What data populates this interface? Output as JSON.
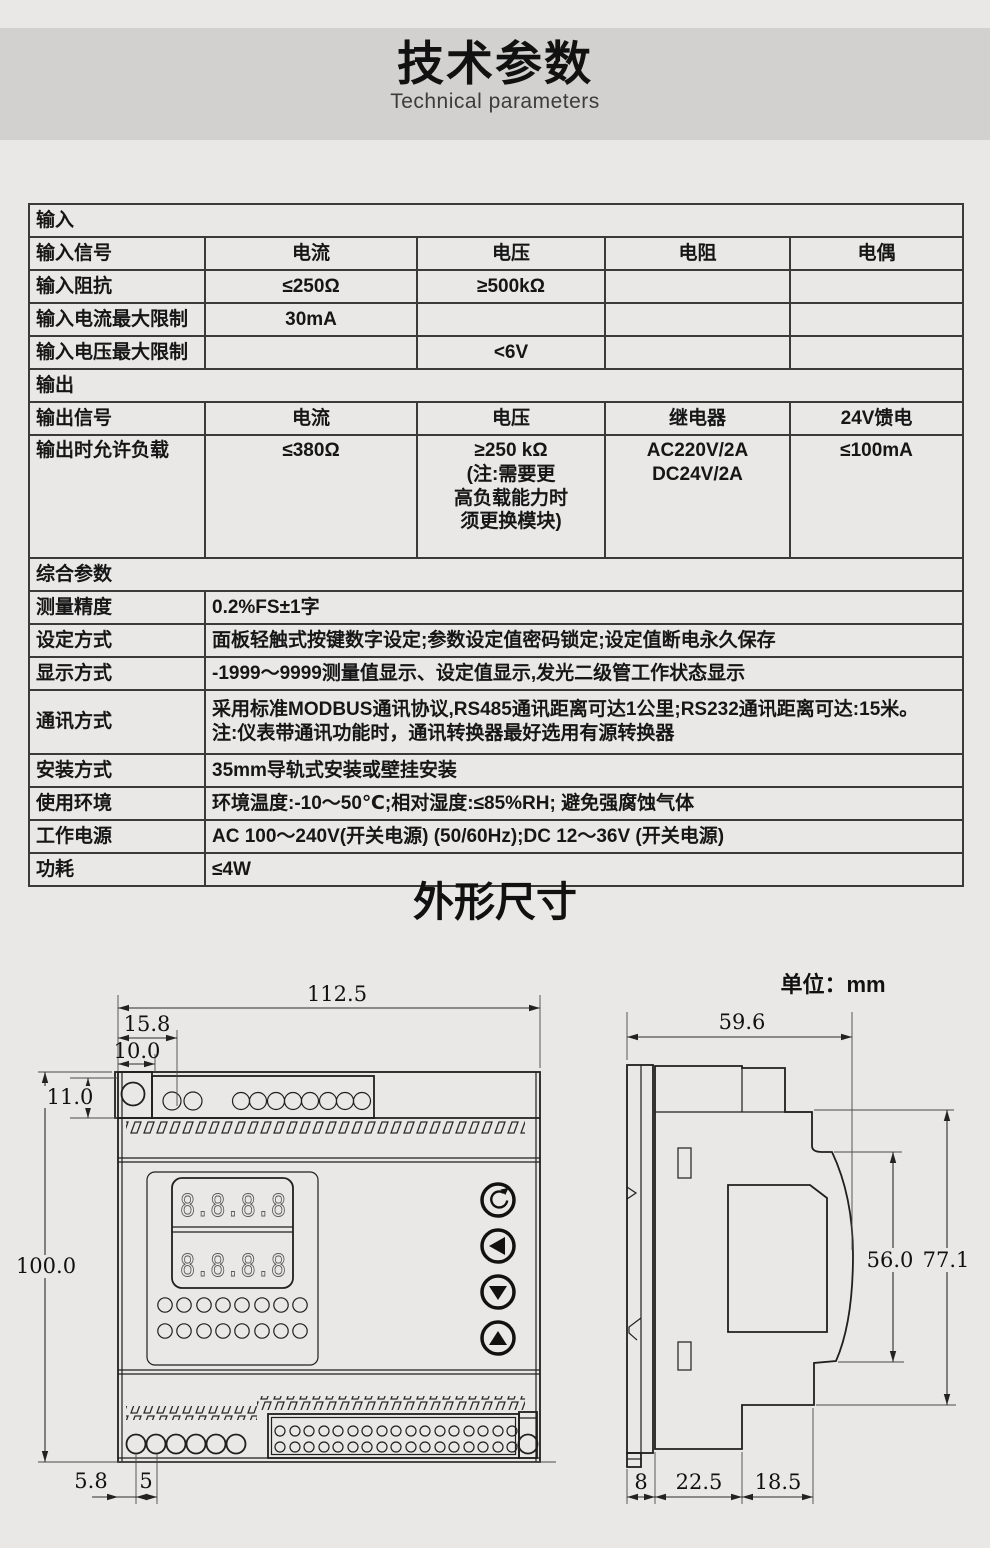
{
  "header": {
    "title": "技术参数",
    "subtitle": "Technical parameters"
  },
  "spec_table": {
    "rows": [
      [
        "输入"
      ],
      [
        "输入信号",
        "电流",
        "电压",
        "电阻",
        "电偶"
      ],
      [
        "输入阻抗",
        "≤250Ω",
        "≥500kΩ",
        "",
        ""
      ],
      [
        "输入电流最大限制",
        "30mA",
        "",
        "",
        ""
      ],
      [
        "输入电压最大限制",
        "",
        "<6V",
        "",
        ""
      ],
      [
        "输出"
      ],
      [
        "输出信号",
        "电流",
        "电压",
        "继电器",
        "24V馈电"
      ],
      [
        "输出时允许负载",
        "≤380Ω",
        "≥250 kΩ\n(注:需要更\n高负载能力时\n须更换模块)",
        "AC220V/2A\nDC24V/2A",
        "≤100mA"
      ],
      [
        "综合参数"
      ],
      [
        "测量精度",
        "0.2%FS±1字"
      ],
      [
        "设定方式",
        "面板轻触式按键数字设定;参数设定值密码锁定;设定值断电永久保存"
      ],
      [
        "显示方式",
        "-1999～9999测量值显示、设定值显示,发光二级管工作状态显示"
      ],
      [
        "通讯方式",
        "采用标准MODBUS通讯协议,RS485通讯距离可达1公里;RS232通讯距离可达:15米。\n注:仪表带通讯功能时，通讯转换器最好选用有源转换器"
      ],
      [
        "安装方式",
        "35mm导轨式安装或壁挂安装"
      ],
      [
        "使用环境",
        "环境温度:-10～50℃;相对湿度:≤85%RH; 避免强腐蚀气体"
      ],
      [
        "工作电源",
        "AC 100～240V(开关电源) (50/60Hz);DC 12～36V (开关电源)"
      ],
      [
        "功耗",
        "≤4W"
      ]
    ]
  },
  "dimensions": {
    "section_title": "外形尺寸",
    "unit_label": "单位：mm",
    "front_view": {
      "total_width": "112.5",
      "terminal_inset": "15.8",
      "hole_offset": "10.0",
      "top_strip_height": "11.0",
      "total_height": "100.0",
      "bottom_edge_offset": "5.8",
      "terminal_pitch": "5",
      "display_top": "8.8.8.8",
      "display_bottom": "8.8.8.8"
    },
    "side_view": {
      "total_width": "59.6",
      "body_depth": "56.0",
      "overall_depth": "77.1",
      "rail_width": "8",
      "mid_depth": "22.5",
      "front_depth": "18.5"
    }
  }
}
